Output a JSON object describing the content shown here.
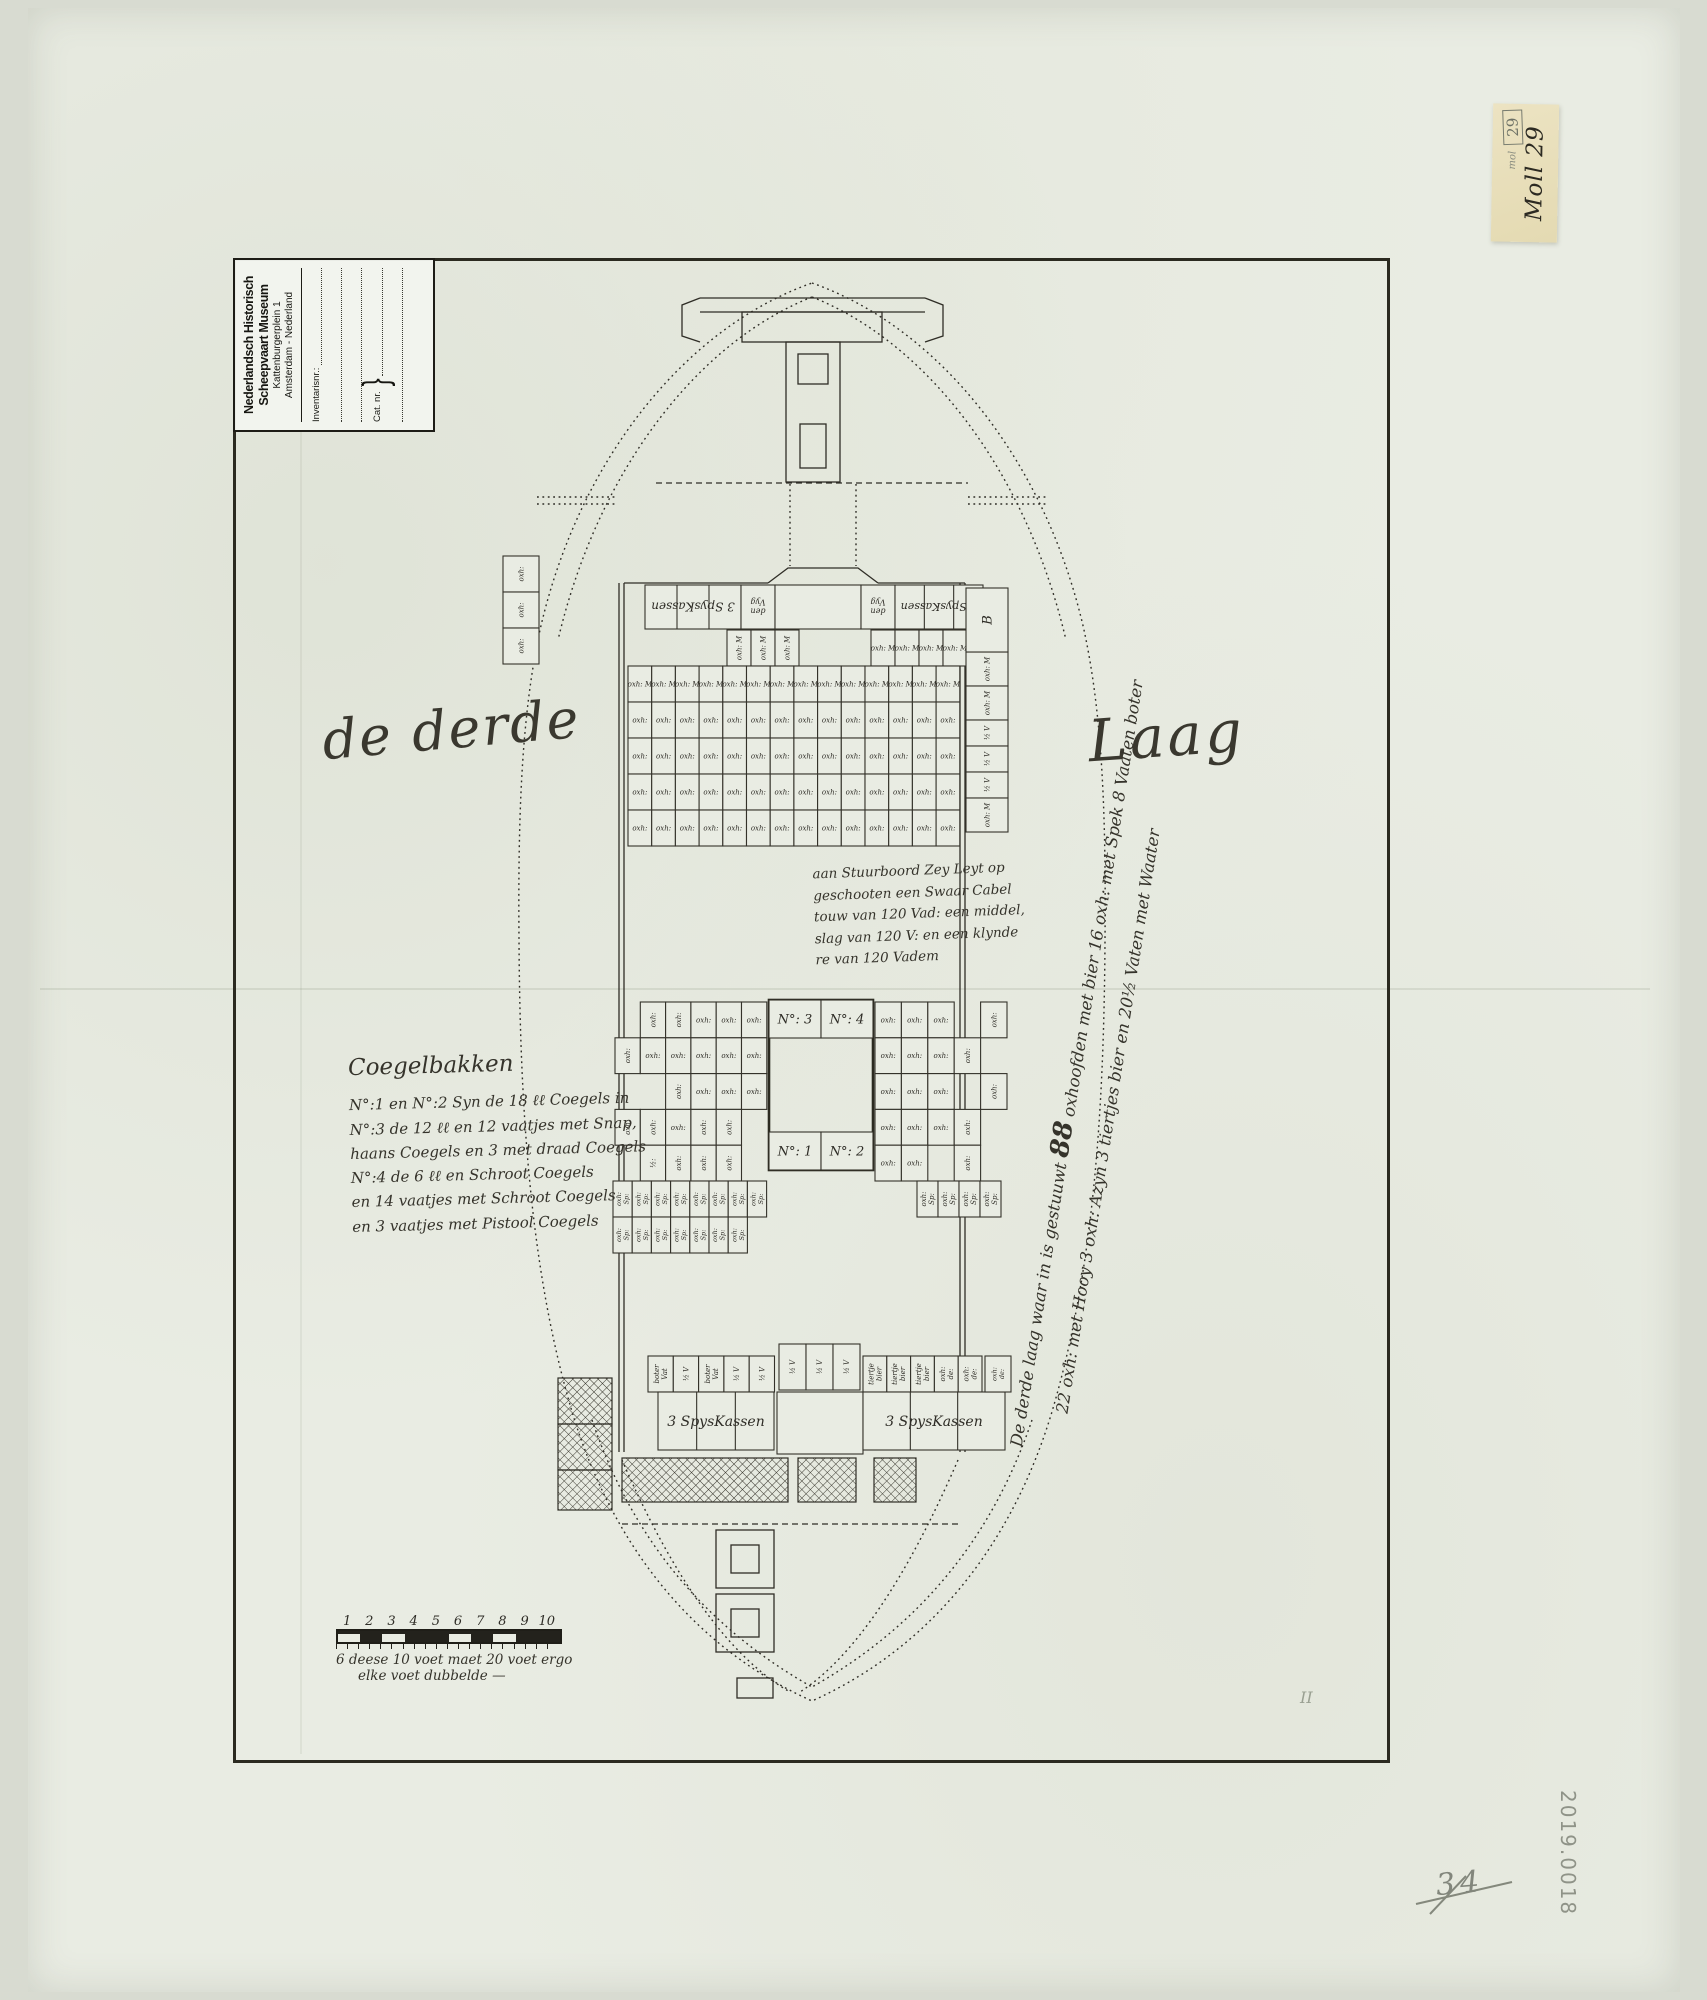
{
  "colors": {
    "paper": "#e9ece3",
    "ink": "#2f2d26",
    "pencil": "#84887c",
    "note_paper": "#e9dfbd"
  },
  "stamp": {
    "line1": "Nederlandsch Historisch",
    "line2": "Scheepvaart Museum",
    "line3": "Kattenburgerplein 1",
    "line4": "Amsterdam  -  Nederland",
    "inventarisnr_label": "Inventarisnr.:",
    "catnr_label": "Cat. nr."
  },
  "sticky_note": {
    "pencil_word": "mol",
    "boxed_number": "29",
    "ink_text": "Moll 29"
  },
  "titles": {
    "left": "de derde",
    "right": "Laag"
  },
  "center_note": {
    "lines": [
      "aan Stuurboord Zey Leyt op",
      "geschooten een Swaar Cabel",
      "touw van 120 Vad: een middel,",
      "slag van 120 V: en een klynde",
      "re van 120 Vadem"
    ]
  },
  "coegelbakken": {
    "title": "Coegelbakken",
    "lines": [
      "N°:1 en N°:2 Syn de 18 ℓℓ Coegels in",
      "N°:3 de 12 ℓℓ en 12 vaatjes met Snap,",
      "haans Coegels en 3 met draad Coegels",
      "N°:4 de 6 ℓℓ en Schroot Coegels",
      "en 14 vaatjes met Schroot Coegels",
      "en 3 vaatjes met Pistool Coegels"
    ]
  },
  "side_note": {
    "line1_pre": "De derde laag waar in is gestuuwt ",
    "line1_num": "88",
    "line1_post": " oxhoofden met bier 16 oxh: met Spek 8 Vaaten boter",
    "line2": "22 oxh: met Hooy 3 oxh: Azyn 3 tiertjes bier en 20½ Vaten met Waater"
  },
  "scale_bar": {
    "numbers": [
      "1",
      "2",
      "3",
      "4",
      "5",
      "6",
      "7",
      "8",
      "9",
      "10"
    ],
    "pattern": "wdwddwdwdd",
    "caption1": "6 deese 10 voet maet 20 voet ergo",
    "caption2": "elke voet dubbelde —"
  },
  "pencil": {
    "page_number": "34",
    "inventory_number": "2019.0018",
    "tally": "II"
  },
  "plan": {
    "grids": [
      {
        "x": 727,
        "y": 630,
        "cw": 24,
        "ch": 36,
        "rows": [
          [
            "^oxh: M",
            "^oxh: M",
            "^oxh: M",
            null,
            null,
            null,
            "oxh: M",
            "oxh: M",
            "oxh: M",
            "oxh: M"
          ]
        ]
      },
      {
        "x": 628,
        "y": 666,
        "cw": 23.7,
        "ch": 36,
        "rows": [
          {
            "n": 14,
            "label": "oxh: M"
          },
          {
            "n": 14,
            "label": "oxh:"
          },
          {
            "n": 14,
            "label": "oxh:"
          },
          {
            "n": 14,
            "label": "oxh:"
          },
          {
            "n": 14,
            "label": "oxh:"
          }
        ]
      },
      {
        "x": 503,
        "y": 556,
        "cw": 36,
        "ch": 36,
        "rows": [
          [
            "^oxh:"
          ],
          [
            "^oxh:"
          ],
          [
            "^oxh:"
          ]
        ]
      },
      {
        "x": 615,
        "y": 1002,
        "cw": 25.3,
        "ch": 35.8,
        "rows": [
          [
            null,
            "^oxh:",
            "^oxh:",
            "oxh:",
            "oxh:",
            "oxh:"
          ],
          [
            "^oxh:",
            "oxh:",
            "oxh:",
            "oxh:",
            "oxh:",
            "oxh:"
          ],
          [
            null,
            null,
            "^oxh:",
            "oxh:",
            "oxh:",
            "oxh:"
          ],
          [
            "^oxh:",
            "^oxh:",
            "oxh:",
            "^oxh:",
            "^oxh:",
            null
          ],
          [
            null,
            "^½:",
            "^oxh:",
            "^oxh:",
            "^oxh:",
            null
          ]
        ]
      },
      {
        "x": 613,
        "y": 1181,
        "cw": 19.2,
        "ch": 36,
        "rows": [
          {
            "n": 8,
            "label": "^oxh:|Sp:"
          },
          {
            "n": 7,
            "label": "^oxh:|Sp:"
          }
        ]
      },
      {
        "x": 875,
        "y": 1002,
        "cw": 26.4,
        "ch": 35.8,
        "rows": [
          [
            "oxh:",
            "oxh:",
            "oxh:",
            null,
            "^oxh:"
          ],
          [
            "oxh:",
            "oxh:",
            "oxh:",
            "^oxh:",
            null
          ],
          [
            "oxh:",
            "oxh:",
            "oxh:",
            null,
            "^oxh:"
          ],
          [
            "oxh:",
            "oxh:",
            "oxh:",
            "^oxh:",
            null
          ],
          [
            "oxh:",
            "oxh:",
            null,
            "^oxh:",
            null
          ]
        ]
      },
      {
        "x": 875,
        "y": 1181,
        "cw": 21,
        "ch": 36,
        "rows": [
          [
            null,
            null,
            "^oxh:|Sp:",
            "^oxh:|Sp:",
            "^oxh:|Sp:",
            "^oxh:|Sp:"
          ]
        ]
      },
      {
        "x": 648,
        "y": 1356,
        "cw": 25.3,
        "ch": 36,
        "rows": [
          [
            "^boter|Vat",
            "^½ V",
            "^boter|Vat",
            "^½ V",
            "^½ V"
          ]
        ]
      },
      {
        "x": 779,
        "y": 1344,
        "cw": 27,
        "ch": 46,
        "rows": [
          [
            "^½ V",
            "^½ V",
            "^½ V"
          ]
        ]
      },
      {
        "x": 863,
        "y": 1356,
        "cw": 23.8,
        "ch": 36,
        "rows": [
          [
            "^tiertje|bier",
            "^tiertje|bier",
            "^tiertje|bier",
            "^oxh:|de:",
            "^oxh:|de:"
          ]
        ]
      },
      {
        "x": 966,
        "y": 652,
        "cw": 42,
        "ch": 34,
        "rows": [
          [
            "^oxh: M"
          ],
          [
            "^oxh: M"
          ]
        ]
      },
      {
        "x": 966,
        "y": 720,
        "cw": 42,
        "ch": 26,
        "rows": [
          [
            "^½ V"
          ],
          [
            "^½ V"
          ],
          [
            "^½ V"
          ]
        ]
      },
      {
        "x": 966,
        "y": 798,
        "cw": 42,
        "ch": 34,
        "rows": [
          [
            "^oxh: M"
          ]
        ]
      }
    ],
    "boxes": [
      {
        "x": 645,
        "y": 585,
        "w": 96,
        "h": 44,
        "div": 3,
        "label": "3 SpysKassen",
        "rot": 180,
        "fs": 12
      },
      {
        "x": 741,
        "y": 585,
        "w": 34,
        "h": 44,
        "label": "den|Vyg",
        "rot": 180,
        "fs": 8
      },
      {
        "x": 775,
        "y": 585,
        "w": 86,
        "h": 44
      },
      {
        "x": 861,
        "y": 585,
        "w": 34,
        "h": 44,
        "label": "den|Vyg",
        "rot": 180,
        "fs": 8
      },
      {
        "x": 895,
        "y": 585,
        "w": 88,
        "h": 44,
        "div": 3,
        "label": "3 SpysKassen",
        "rot": 180,
        "fs": 11
      },
      {
        "x": 966,
        "y": 588,
        "w": 42,
        "h": 64,
        "label": "B",
        "rot": -90,
        "fs": 13
      },
      {
        "x": 769,
        "y": 1000,
        "w": 104,
        "h": 170,
        "thick": true
      },
      {
        "x": 769,
        "y": 1000,
        "w": 52,
        "h": 38,
        "label": "N°: 3",
        "fs": 13
      },
      {
        "x": 821,
        "y": 1000,
        "w": 52,
        "h": 38,
        "label": "N°: 4",
        "fs": 13
      },
      {
        "x": 769,
        "y": 1132,
        "w": 52,
        "h": 38,
        "label": "N°: 1",
        "fs": 13
      },
      {
        "x": 821,
        "y": 1132,
        "w": 52,
        "h": 38,
        "label": "N°: 2",
        "fs": 13
      },
      {
        "x": 658,
        "y": 1392,
        "w": 116,
        "h": 58,
        "div": 3,
        "label": "3 SpysKassen",
        "fs": 14
      },
      {
        "x": 777,
        "y": 1392,
        "w": 86,
        "h": 62
      },
      {
        "x": 863,
        "y": 1392,
        "w": 142,
        "h": 58,
        "div": 3,
        "label": "3 SpysKassen",
        "fs": 14
      },
      {
        "x": 985,
        "y": 1356,
        "w": 26,
        "h": 36,
        "label": "^oxh:|de:",
        "fs": 6.5
      }
    ]
  }
}
